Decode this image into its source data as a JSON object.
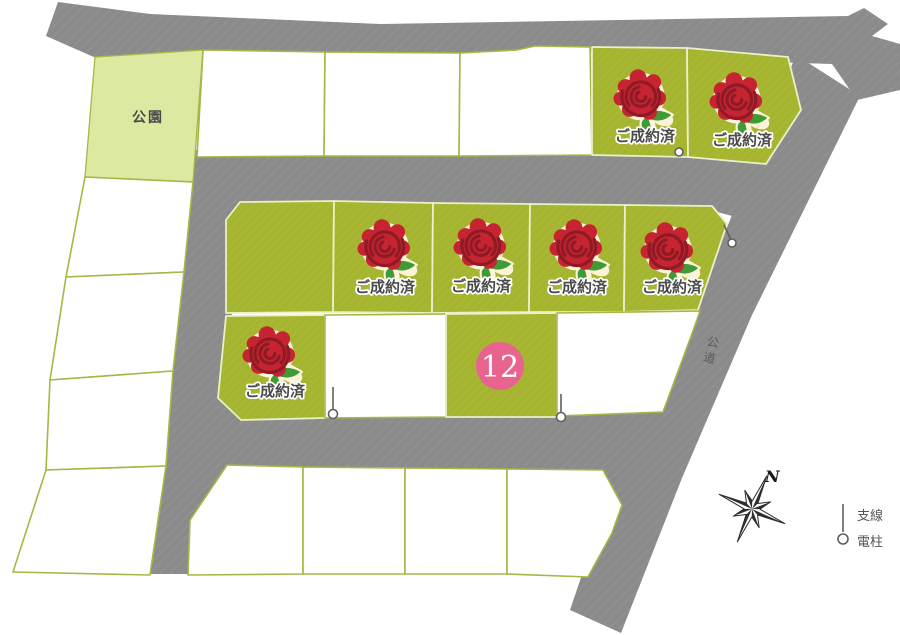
{
  "map": {
    "park_label": "公園",
    "public_road_label": "公道",
    "sold_stamp_label": "ご成約済",
    "lot_number_12": "12",
    "compass_north_label": "N",
    "legend": {
      "support_line_label": "支線",
      "utility_pole_label": "電柱"
    },
    "summary": {
      "sold_lots": 7,
      "numbered_lots_for_sale": [
        "12"
      ],
      "unmarked_lots": 13,
      "park_count": 1
    },
    "colors": {
      "road_gray": "#8b8b8b",
      "sold_green": "#a6b52f",
      "park_green": "#dce9a0",
      "lot_border": "#a9b545",
      "sold_border": "#eaf0c8",
      "rose_red": "#c52430",
      "rose_dark": "#8e1a26",
      "leaf_green": "#3f9b35",
      "halo_cream": "#fdf3d8",
      "badge_pink": "#e9638f",
      "text_dark": "#4a4a4a",
      "pole_gray": "#5f5f5f"
    }
  }
}
